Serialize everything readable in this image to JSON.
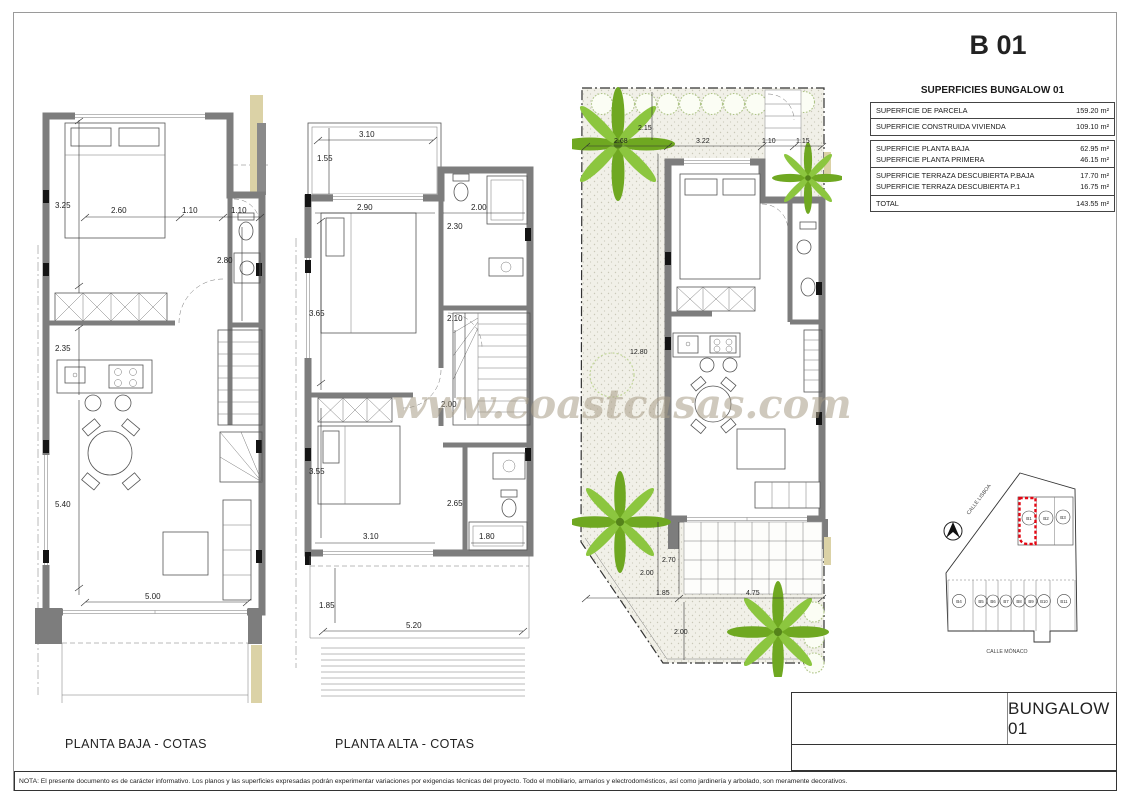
{
  "sheet": {
    "code": "B 01"
  },
  "watermark": "www.coastcasas.com",
  "note": "NOTA: El presente documento es de carácter informativo. Los planos y las superficies expresadas podrán experimentar variaciones por exigencias técnicas del proyecto. Todo el mobiliario, armarios y electrodomésticos, así como jardinería y arbolado, son meramente decorativos.",
  "title_block": {
    "name": "BUNGALOW 01"
  },
  "areas_table": {
    "title": "SUPERFICIES BUNGALOW 01",
    "rows": [
      {
        "label": "SUPERFICIE DE PARCELA",
        "value": "159.20 m²"
      },
      {
        "label": "SUPERFICIE CONSTRUIDA VIVIENDA",
        "value": "109.10 m²"
      },
      {
        "label": "SUPERFICIE PLANTA BAJA",
        "value": "62.95 m²"
      },
      {
        "label": "SUPERFICIE PLANTA PRIMERA",
        "value": "46.15 m²"
      },
      {
        "label": "SUPERFICIE TERRAZA DESCUBIERTA P.BAJA",
        "value": "17.70 m²"
      },
      {
        "label": "SUPERFICIE TERRAZA DESCUBIERTA P.1",
        "value": "16.75 m²"
      },
      {
        "label": "TOTAL",
        "value": "143.55 m²"
      }
    ]
  },
  "plans": {
    "planta_baja": {
      "label": "PLANTA BAJA - COTAS",
      "dims": [
        "3.25",
        "2.60",
        "1.10",
        "1.10",
        "2.80",
        "2.35",
        "5.40",
        "5.00"
      ]
    },
    "planta_alta": {
      "label": "PLANTA ALTA - COTAS",
      "dims": [
        "3.10",
        "1.55",
        "2.90",
        "2.00",
        "2.30",
        "3.65",
        "2.10",
        "2.00",
        "3.55",
        "2.65",
        "3.10",
        "1.80",
        "1.85",
        "5.20"
      ]
    },
    "parcela": {
      "dims": [
        "2.15",
        "2.68",
        "3.22",
        "1.10",
        "1.15",
        "12.80",
        "2.70",
        "2.00",
        "1.85",
        "4.75",
        "2.00"
      ]
    }
  },
  "site_plan": {
    "street_top": "CALLE LISBOA",
    "street_bottom": "CALLE MÓNACO",
    "lots": [
      "B1",
      "B2",
      "B3",
      "B4",
      "B5",
      "B6",
      "B7",
      "B8",
      "B9",
      "B10",
      "B11"
    ],
    "highlighted_lot": "B1"
  },
  "colors": {
    "wall_gray": "#7d7d7d",
    "accent_red": "#e30613",
    "palm_green": "#7cb529",
    "hedge_green": "#aec487",
    "tan": "#dbd2a6",
    "watermark": "#a89c86"
  }
}
